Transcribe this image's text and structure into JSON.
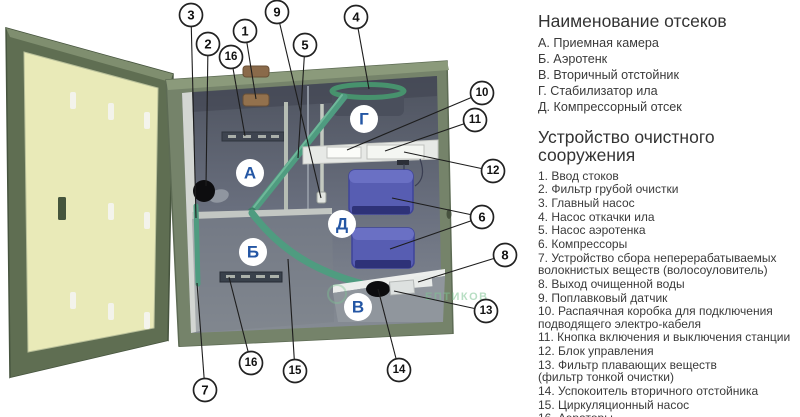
{
  "legend": {
    "s1": {
      "title": "Наименование отсеков",
      "items": [
        "А. Приемная камера",
        "Б. Аэротенк",
        "В. Вторичный отстойник",
        "Г.  Стабилизатор ила",
        "Д. Компрессорный отсек"
      ]
    },
    "s2": {
      "title": "Устройство очистного\nсооружения",
      "items": [
        "1. Ввод стоков",
        "2. Фильтр грубой очистки",
        "3. Главный насос",
        "4. Насос откачки ила",
        "5. Насос аэротенка",
        "6. Компрессоры",
        "7. Устройство сбора неперерабатываемых\nволокнистых веществ (волосоуловитель)",
        "8. Выход очищенной воды",
        "9. Поплавковый датчик",
        "10. Распаячная коробка для подключения\nподводящего электро-кабеля",
        "11. Кнопка включения и выключения станции",
        "12. Блок управления",
        "13. Фильтр плавающих веществ\n(фильтр тонкой очистки)",
        "14. Успокоитель вторичного отстойника",
        "15. Циркуляционный насос",
        "16. Аэраторы"
      ]
    }
  },
  "diagram": {
    "compartments": {
      "a": "А",
      "b": "Б",
      "v": "В",
      "g": "Г",
      "d": "Д"
    },
    "callouts": {
      "n1": "1",
      "n2": "2",
      "n3": "3",
      "n4": "4",
      "n5": "5",
      "n6": "6",
      "n7": "7",
      "n8": "8",
      "n9": "9",
      "n10": "10",
      "n11": "11",
      "n12": "12",
      "n13": "13",
      "n14": "14",
      "n15": "15",
      "n16a": "16",
      "n16b": "16"
    },
    "watermark": "ЕПТИКОВ"
  },
  "colors": {
    "accent_blue": "#2456a4",
    "casing_green": "#75836a",
    "door_panel": "#e9eab8",
    "pipe_green": "#4f9c80",
    "compressor_blue": "#575db2",
    "watermark_green": "#7ec493"
  }
}
